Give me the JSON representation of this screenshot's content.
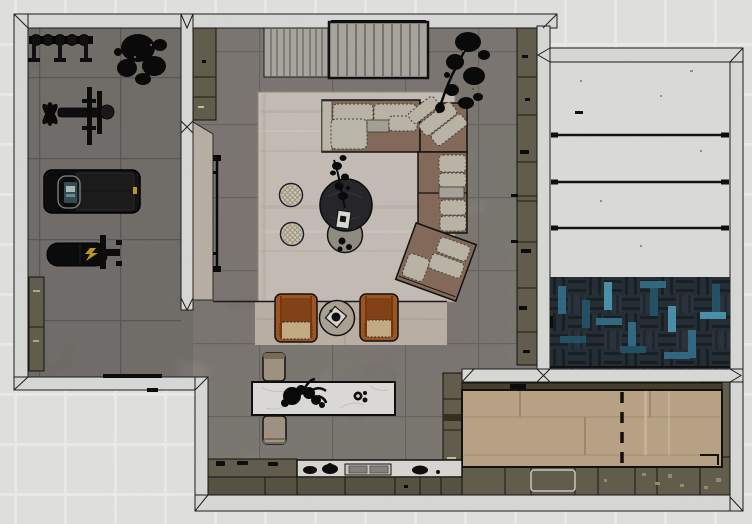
{
  "scene": {
    "description": "Top-down 3D rendered floor plan of a basement: home gym (top-left), living lounge with sectional sofa (center), media slat wall (top), staircase hall with herringbone runner (right), game room with wooden shuffleboard deck (bottom-right), kitchenette counter and marble island (bottom).",
    "rooms": [
      {
        "name": "home-gym",
        "position": "top-left",
        "floor": "grey tile"
      },
      {
        "name": "living-lounge",
        "position": "center",
        "floor": "grey concrete tile"
      },
      {
        "name": "staircase-hall",
        "position": "right",
        "floor": "white treads + herringbone runner"
      },
      {
        "name": "game-room",
        "position": "bottom-right",
        "floor": "olive cabinetry + oak deck"
      },
      {
        "name": "kitchenette",
        "position": "bottom-center",
        "floor": "grey concrete tile"
      }
    ],
    "stairs": {
      "tread_count": 4
    },
    "objects": [
      {
        "name": "weight-plate-rack",
        "room": "home-gym"
      },
      {
        "name": "gym-plant",
        "room": "home-gym"
      },
      {
        "name": "bench-press-station",
        "room": "home-gym"
      },
      {
        "name": "treadmill",
        "room": "home-gym"
      },
      {
        "name": "workout-bench",
        "room": "home-gym"
      },
      {
        "name": "gym-storage-cabinet",
        "room": "home-gym"
      },
      {
        "name": "media-slat-panel-left",
        "room": "living-lounge"
      },
      {
        "name": "media-slat-panel-right",
        "room": "living-lounge"
      },
      {
        "name": "living-storage-cabinet",
        "room": "living-lounge"
      },
      {
        "name": "wall-tv",
        "room": "living-lounge"
      },
      {
        "name": "area-rug",
        "room": "living-lounge"
      },
      {
        "name": "sectional-sofa",
        "room": "living-lounge"
      },
      {
        "name": "corner-plant",
        "room": "living-lounge"
      },
      {
        "name": "pouf-1",
        "room": "living-lounge"
      },
      {
        "name": "pouf-2",
        "room": "living-lounge"
      },
      {
        "name": "coffee-table-dark",
        "room": "living-lounge"
      },
      {
        "name": "nesting-table-gray",
        "room": "living-lounge"
      },
      {
        "name": "table-plant",
        "room": "living-lounge"
      },
      {
        "name": "armchair-left",
        "room": "living-lounge"
      },
      {
        "name": "armchair-right",
        "room": "living-lounge"
      },
      {
        "name": "round-side-table",
        "room": "living-lounge"
      },
      {
        "name": "tall-bookshelf",
        "room": "living-lounge"
      },
      {
        "name": "kitchen-island",
        "room": "kitchenette"
      },
      {
        "name": "bar-stool-top",
        "room": "kitchenette"
      },
      {
        "name": "bar-stool-bottom",
        "room": "kitchenette"
      },
      {
        "name": "island-decor",
        "room": "kitchenette"
      },
      {
        "name": "kitchen-counter",
        "room": "kitchenette"
      },
      {
        "name": "cooktop",
        "room": "kitchenette"
      },
      {
        "name": "herringbone-rug",
        "room": "staircase-hall"
      },
      {
        "name": "shuffleboard-deck",
        "room": "game-room"
      },
      {
        "name": "game-cabinets",
        "room": "game-room"
      },
      {
        "name": "dishwasher",
        "room": "game-room"
      }
    ]
  },
  "colors": {
    "bg": "#f0f0ee",
    "bg-line": "#fbfbfa",
    "wall-fill": "#e8e8e6",
    "wall-stroke": "#1f1f1f",
    "gym-floor": "#7b7671",
    "main-floor": "#8a847c",
    "rug": "#d2cac2",
    "platform": "#c7bcb1",
    "sofa-base": "#8d7262",
    "cushion": "#c7c2b3",
    "cushion-stroke": "#4a473c",
    "pouf": "#dcd4be",
    "table-dark": "#2a292d",
    "table-gray": "#9b978c",
    "chair-rust": "#a85c26",
    "chair-rust-dark": "#8d4718",
    "chair-cushion": "#d2b88f",
    "side-table": "#b7ad9e",
    "tray-white": "#e9e6df",
    "slat-panel": "#b5b2ab",
    "slat-line": "#5f5c55",
    "olive-cab": "#6a6453",
    "olive-dark": "#56513f",
    "olive-front": "#5d5848",
    "tan-wall": "#c6bcb1",
    "plant": "#0b0b0b",
    "stair-tread": "#ebebe9",
    "stair-line": "#161616",
    "herring-base": "#28313a",
    "herring-teal": "#3a7e9c",
    "herring-teal2": "#2a5e77",
    "herring-teal-bright": "#56aecb",
    "wood-deck": "#c6ae90",
    "wood-edge": "#49452f",
    "counter-marble": "#e7e5e0",
    "island-marble": "#eceae6",
    "stool": "#ab9d8a",
    "equip-black": "#121212",
    "screen-teal": "#37535c",
    "accent-yellow": "#c9a325"
  }
}
